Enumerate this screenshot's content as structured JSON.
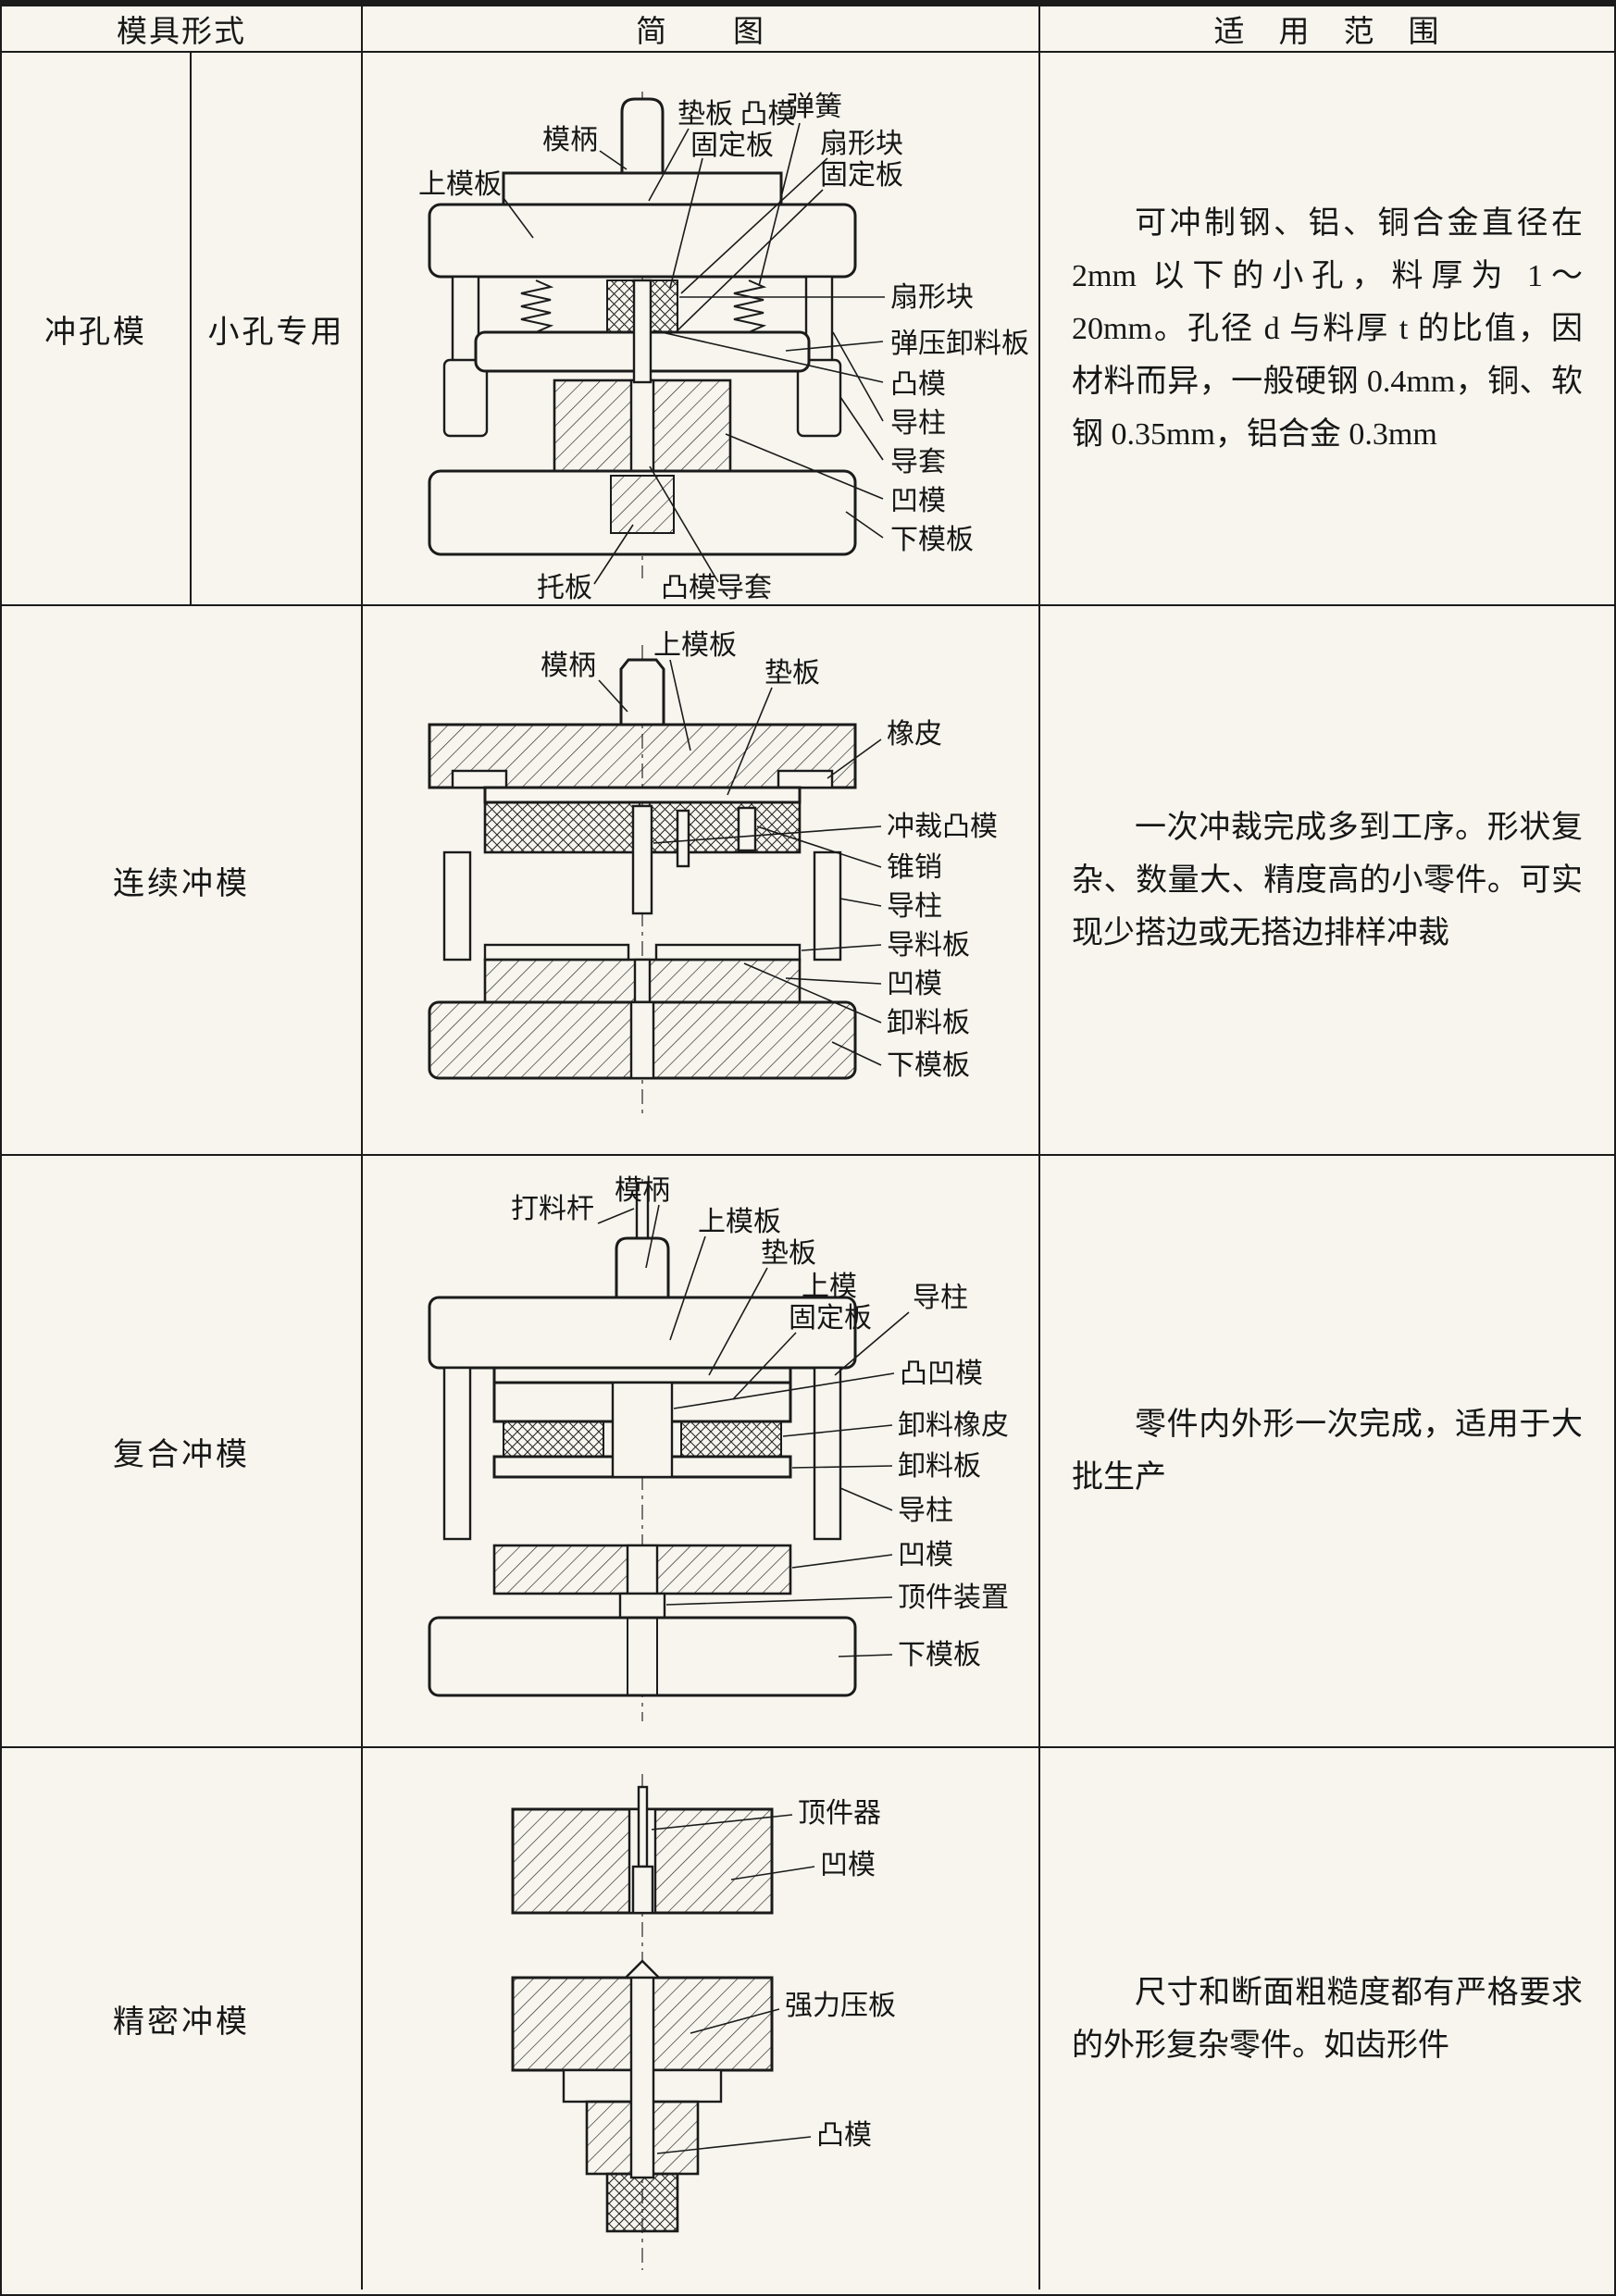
{
  "page": {
    "background": "#f7f5ee",
    "line_color": "#1b1b1b"
  },
  "header": {
    "form": "模具形式",
    "diagram": "简　　图",
    "scope": "适　用　范　围"
  },
  "rows": [
    {
      "form": "冲孔模",
      "form_sub": "小孔专用",
      "scope": "可冲制钢、铝、铜合金直径在 2mm 以下的小孔，料厚为 1～20mm。孔径 d 与料厚 t 的比值，因材料而异，一般硬钢 0.4mm，铜、软钢 0.35mm，铝合金 0.3mm",
      "labels": [
        "模柄",
        "垫板 凸模",
        "固定板",
        "弹簧",
        "扇形块",
        "固定板",
        "上模板",
        "扇形块",
        "弹压卸料板",
        "凸模",
        "导柱",
        "导套",
        "凹模",
        "下模板",
        "托板",
        "凸模导套"
      ]
    },
    {
      "form": "连续冲模",
      "scope": "一次冲裁完成多到工序。形状复杂、数量大、精度高的小零件。可实现少搭边或无搭边排样冲裁",
      "labels": [
        "模柄",
        "上模板",
        "垫板",
        "橡皮",
        "冲裁凸模",
        "锥销",
        "导柱",
        "导料板",
        "凹模",
        "卸料板",
        "下模板"
      ]
    },
    {
      "form": "复合冲模",
      "scope": "零件内外形一次完成，适用于大批生产",
      "labels": [
        "打料杆",
        "模柄",
        "上模板",
        "垫板",
        "上模",
        "固定板",
        "导柱",
        "凸凹模",
        "卸料橡皮",
        "卸料板",
        "导柱",
        "凹模",
        "顶件装置",
        "下模板"
      ]
    },
    {
      "form": "精密冲模",
      "scope": "尺寸和断面粗糙度都有严格要求的外形复杂零件。如齿形件",
      "labels": [
        "顶件器",
        "凹模",
        "强力压板",
        "凸模"
      ]
    }
  ]
}
